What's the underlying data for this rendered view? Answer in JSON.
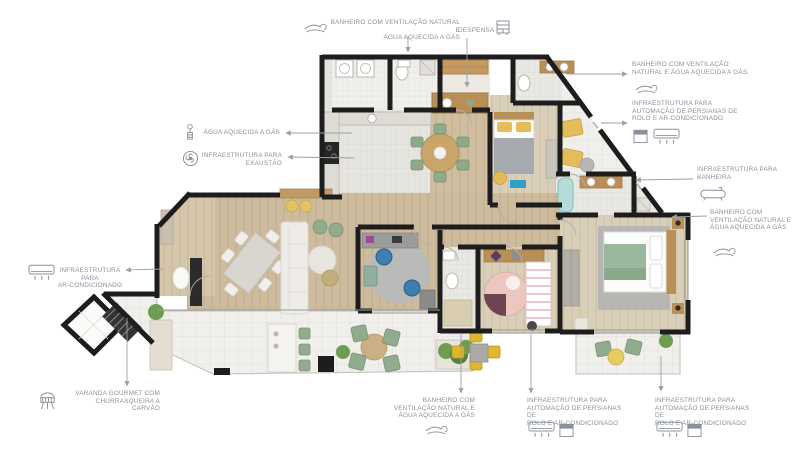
{
  "colors": {
    "wall": "#1d1d1d",
    "label_text": "#8b909a",
    "leader_line": "#9aa0a8",
    "wood_floor": "#cdbb9d",
    "wood_floor_light": "#d9ceb8",
    "tile_floor": "#eae8e3",
    "terrace_tile": "#f0efec",
    "cabinet_wood": "#b98f58",
    "accent_yellow": "#e4bd5a",
    "accent_green": "#93ab8d",
    "accent_teal": "#2f9fc4",
    "accent_blue": "#3e7fb0",
    "accent_pink": "#ecc7bf",
    "bathtub_blue": "#b5dcd8"
  },
  "annotations": {
    "bathroom_top": {
      "text": "BANHEIRO COM VENTILAÇÃO NATURAL E\nÁGUA AQUECIDA A GÁS",
      "icon": "wind-icon"
    },
    "despensa": {
      "text": "DESPENSA",
      "icon": "pantry-shelf-icon"
    },
    "bathroom_right_top": {
      "text": "BANHEIRO COM VENTILAÇÃO\nNATURAL E ÁGUA AQUECIDA A GÁS.",
      "icon": "wind-icon"
    },
    "persianas_right": {
      "text": "INFRAESTRUTURA PARA\nAUTOMAÇÃO DE PERSIANAS DE\nROLO E AR-CONDICIONADO",
      "icons": [
        "roller-blind-icon",
        "ac-unit-icon"
      ]
    },
    "banheira": {
      "text": "INFRAESTRUTURA PARA\nBANHEIRA",
      "icon": "bathtub-icon"
    },
    "bathroom_right_mid": {
      "text": "BANHEIRO COM\nVENTILAÇÃO NATURAL E\nÁGUA AQUECIDA A GÁS",
      "icon": "wind-icon"
    },
    "agua_aquecida": {
      "text": "ÁGUA AQUECIDA A GÁS",
      "icon": "gas-shower-icon"
    },
    "exaustao": {
      "text": "INFRAESTRUTURA PARA\nEXAUSTÃO",
      "icon": "exhaust-fan-icon"
    },
    "ar_condicionado": {
      "text": "INFRAESTRUTURA PARA\nAR-CONDICIONADO",
      "icon": "ac-unit-icon"
    },
    "varanda_gourmet": {
      "text": "VARANDA GOURMET COM\nCHURRASQUEIRA A\nCARVÃO",
      "icon": "grill-icon"
    },
    "bathroom_bottom": {
      "text": "BANHEIRO COM\nVENTILAÇÃO NATURAL E\nÁGUA AQUECIDA A GÁS",
      "icon": "wind-icon"
    },
    "persianas_bottom_left": {
      "text": "INFRAESTRUTURA PARA\nAUTOMAÇÃO DE PERSIANAS DE\nROLO E AR-CONDICIONADO",
      "icons": [
        "ac-unit-icon",
        "roller-blind-icon"
      ]
    },
    "persianas_bottom_right": {
      "text": "INFRAESTRUTURA PARA\nAUTOMAÇÃO DE PERSIANAS DE\nROLO E AR-CONDICIONADO",
      "icons": [
        "ac-unit-icon",
        "roller-blind-icon"
      ]
    }
  }
}
